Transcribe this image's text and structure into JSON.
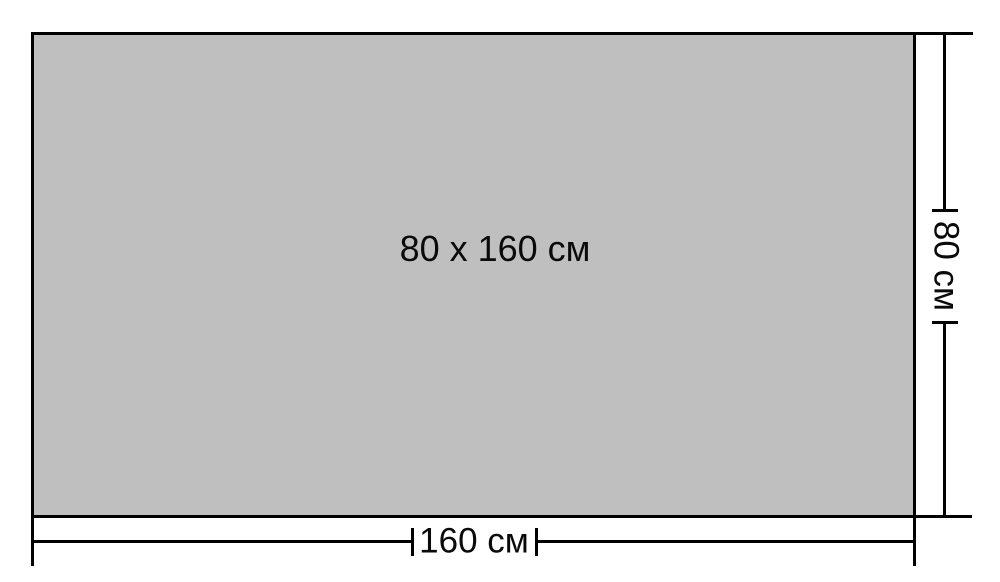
{
  "diagram": {
    "object_label": "80 x 160 см",
    "width_dimension": {
      "label": "160 см",
      "value_cm": 160
    },
    "height_dimension": {
      "label": "80 см",
      "value_cm": 80
    },
    "colors": {
      "fill": "#bfbfbf",
      "line": "#000000",
      "background": "#ffffff",
      "text": "#0a0a0a"
    }
  }
}
